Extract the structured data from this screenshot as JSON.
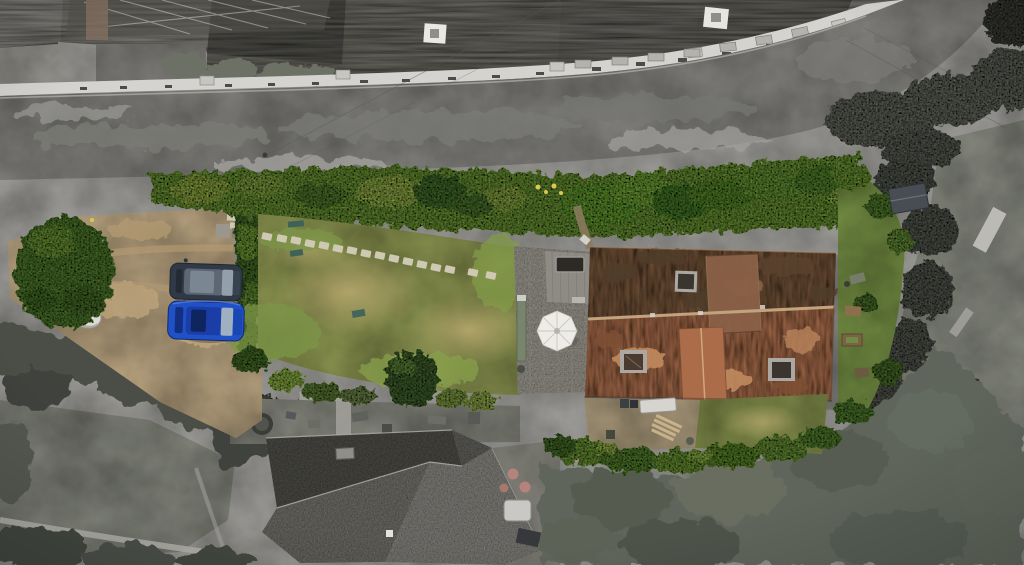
{
  "scene": {
    "kind": "aerial-drone-photograph",
    "treatment": "subject property shown in colour, surrounding neighbourhood desaturated to greyscale",
    "subject": "long narrow garden plot with gravel drive, lawn, patio and red-tiled house",
    "visible_objects": [
      "terraced houses with slate roofs along road",
      "asphalt road curving to top right",
      "bright garden hedges along roadside",
      "gravel driveway with two parked cars",
      "dark grey SUV",
      "bright blue car",
      "lawn with stepping-stone path",
      "paved patio with white parasol",
      "timber deck with dark rooflight",
      "red clay-tiled house with three rooflights",
      "small dark garden shed",
      "rear gravel yard with white table",
      "neighbouring grey stone house with hipped roof",
      "dark conifer screening and grey paddock"
    ],
    "counts": {
      "parked_cars": 2,
      "rooflights_on_house": 3,
      "parasols": 1
    }
  },
  "palette": {
    "road": "#8f8e8a",
    "road_dark": "#7b7a76",
    "road_light": "#a2a19d",
    "slate": "#76746c",
    "slate_dark": "#5b5a54",
    "slate_light": "#9d9b95",
    "house_front": "#d4d3cf",
    "yard": "#b2b1ad",
    "yard_dark": "#8b8a85",
    "shrub_gray": "#6d7165",
    "scrub": "#71756a",
    "tree_dark": "#4b4e47",
    "conifer": "#5f655a",
    "field": "#93968b",
    "field_light": "#b1b0a9",
    "path_light": "#b6b5af",
    "neighbour_roof_dark": "#56554f",
    "neighbour_roof": "#7c7b74",
    "neighbour_roof_light": "#908f89",
    "pink_furniture": "#b4837c",
    "hedge": "#79a73b",
    "hedge_lime": "#9dbd4a",
    "hedge_dark": "#4f7a2b",
    "hedge_deep": "#3a5c22",
    "lawn": "#97a158",
    "lawn_dry": "#b5a76d",
    "lawn_green": "#7c9647",
    "gravel": "#c9b28c",
    "gravel_dark": "#b0986f",
    "stone": "#cfc9b3",
    "patio": "#a7a399",
    "deck": "#8e8a84",
    "parasol": "#eeece6",
    "roof_top": "#7c5a3f",
    "roof_top_dark": "#503c2a",
    "roof_bottom": "#b17350",
    "roof_bottom_light": "#c68e62",
    "roof_ridge": "#c2a27f",
    "skylight": "#3a352f",
    "skylight_frame": "#aba8a2",
    "car_suv": "#303a46",
    "car_suv_roof": "#5c6773",
    "car_glass": "#93a0ac",
    "car_blue": "#2151c6",
    "car_blue_roof": "#1b3da8",
    "shed": "#484d53",
    "white_object": "#dcdad4",
    "garden_grass": "#7e9a4a",
    "back_gravel": "#b7a685"
  }
}
